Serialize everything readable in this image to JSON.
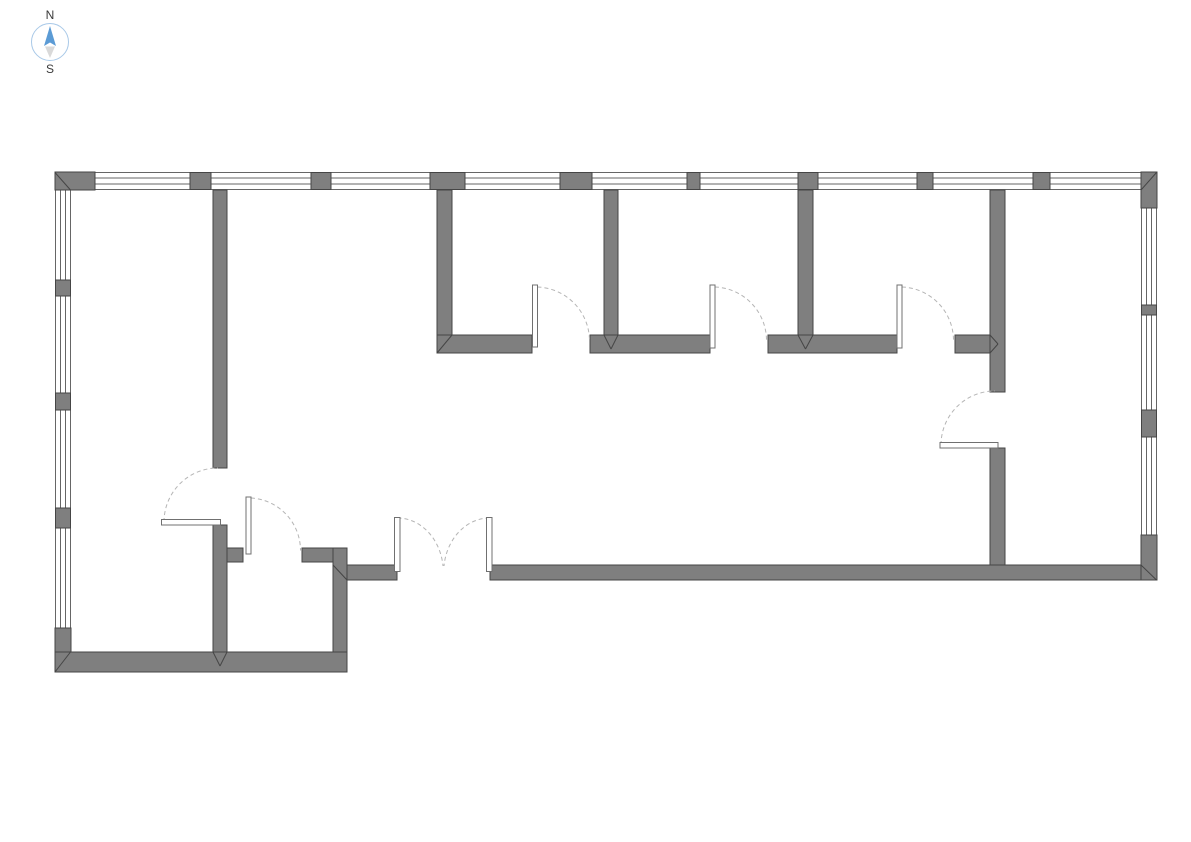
{
  "canvas": {
    "width": 1191,
    "height": 842
  },
  "compass": {
    "north_label": "N",
    "south_label": "S"
  },
  "colors": {
    "background": "#ffffff",
    "wall_fill": "#7f7f7f",
    "wall_stroke": "#454545",
    "window_stroke": "#666666",
    "arc_stroke": "#b5b5b5",
    "leaf_fill": "#ffffff",
    "leaf_stroke": "#707070",
    "compass_circle": "#a9c9e8",
    "compass_north": "#5b9bd5",
    "compass_south": "#d9d9d9",
    "compass_text": "#3a3a3a"
  },
  "plan": {
    "windows": [
      {
        "name": "window-band-north",
        "dir": "h",
        "x": 55.5,
        "y": 172.5,
        "w": 1101,
        "h": 17
      },
      {
        "name": "window-band-west",
        "dir": "v",
        "x": 55.5,
        "y": 188,
        "w": 15,
        "h": 440
      },
      {
        "name": "window-band-east",
        "dir": "v",
        "x": 1141.5,
        "y": 205,
        "w": 15,
        "h": 332
      }
    ],
    "piers": [
      {
        "name": "window-pier-north-1",
        "x": 190,
        "y": 172.5,
        "w": 21,
        "h": 17
      },
      {
        "name": "window-pier-north-2",
        "x": 311,
        "y": 172.5,
        "w": 20,
        "h": 17
      },
      {
        "name": "window-pier-north-3",
        "x": 430,
        "y": 172.5,
        "w": 35,
        "h": 17
      },
      {
        "name": "window-pier-north-4",
        "x": 560,
        "y": 172.5,
        "w": 32,
        "h": 17
      },
      {
        "name": "window-pier-north-5",
        "x": 687,
        "y": 172.5,
        "w": 13,
        "h": 17
      },
      {
        "name": "window-pier-north-6",
        "x": 798,
        "y": 172.5,
        "w": 20,
        "h": 17
      },
      {
        "name": "window-pier-north-7",
        "x": 917,
        "y": 172.5,
        "w": 16,
        "h": 17
      },
      {
        "name": "window-pier-north-8",
        "x": 1033,
        "y": 172.5,
        "w": 17,
        "h": 17
      },
      {
        "name": "window-pier-west-1",
        "x": 55.5,
        "y": 280,
        "w": 15,
        "h": 16
      },
      {
        "name": "window-pier-west-2",
        "x": 55.5,
        "y": 393,
        "w": 15,
        "h": 17
      },
      {
        "name": "window-pier-west-3",
        "x": 55.5,
        "y": 508,
        "w": 15,
        "h": 20
      },
      {
        "name": "window-pier-east-1",
        "x": 1141.5,
        "y": 305,
        "w": 15,
        "h": 10
      },
      {
        "name": "window-pier-east-2",
        "x": 1141.5,
        "y": 410,
        "w": 15,
        "h": 27
      }
    ],
    "corner_blocks": [
      {
        "name": "wall-corner-northwest",
        "x": 55,
        "y": 172,
        "w": 40,
        "h": 18
      },
      {
        "name": "wall-corner-northeast",
        "x": 1141,
        "y": 172,
        "w": 16,
        "h": 36
      },
      {
        "name": "wall-corner-southeast",
        "x": 1141,
        "y": 535,
        "w": 16,
        "h": 45
      },
      {
        "name": "wall-corner-southwest",
        "x": 55,
        "y": 628,
        "w": 16,
        "h": 44
      }
    ],
    "walls": [
      {
        "name": "left-room-partition-upper",
        "x": 213,
        "y": 190,
        "w": 14,
        "h": 278
      },
      {
        "name": "left-room-partition-lower",
        "x": 213,
        "y": 525,
        "w": 14,
        "h": 127
      },
      {
        "name": "room-divider-1",
        "x": 437,
        "y": 190,
        "w": 15,
        "h": 146
      },
      {
        "name": "room-divider-2",
        "x": 604,
        "y": 190,
        "w": 14,
        "h": 146
      },
      {
        "name": "room-divider-3",
        "x": 798,
        "y": 190,
        "w": 15,
        "h": 146
      },
      {
        "name": "right-partition-upper",
        "x": 990,
        "y": 190,
        "w": 15,
        "h": 202
      },
      {
        "name": "right-partition-lower",
        "x": 990,
        "y": 448,
        "w": 15,
        "h": 118
      },
      {
        "name": "rooms-front-wall-a",
        "x": 437,
        "y": 335,
        "w": 95,
        "h": 18
      },
      {
        "name": "rooms-front-wall-b",
        "x": 590,
        "y": 335,
        "w": 120,
        "h": 18
      },
      {
        "name": "rooms-front-wall-c",
        "x": 768,
        "y": 335,
        "w": 129,
        "h": 18
      },
      {
        "name": "rooms-front-wall-d",
        "x": 955,
        "y": 335,
        "w": 35,
        "h": 18
      },
      {
        "name": "closet-top-wall-a",
        "x": 227,
        "y": 548,
        "w": 16,
        "h": 14
      },
      {
        "name": "closet-top-wall-b",
        "x": 302,
        "y": 548,
        "w": 31,
        "h": 14
      },
      {
        "name": "closet-right-wall",
        "x": 333,
        "y": 548,
        "w": 14,
        "h": 105
      },
      {
        "name": "bottom-wall-left",
        "x": 55,
        "y": 652,
        "w": 292,
        "h": 20
      },
      {
        "name": "bottom-wall-mid",
        "x": 347,
        "y": 565,
        "w": 50,
        "h": 15
      },
      {
        "name": "bottom-wall-right",
        "x": 490,
        "y": 565,
        "w": 651,
        "h": 15
      }
    ],
    "miters": [
      {
        "x1": 55,
        "y1": 172.5,
        "x2": 70.5,
        "y2": 190
      },
      {
        "x1": 1156.5,
        "y1": 172.5,
        "x2": 1141,
        "y2": 190
      },
      {
        "x1": 1141,
        "y1": 565,
        "x2": 1156.5,
        "y2": 580
      },
      {
        "x1": 70.5,
        "y1": 652,
        "x2": 55,
        "y2": 672
      },
      {
        "x1": 437,
        "y1": 353,
        "x2": 452,
        "y2": 335
      },
      {
        "x1": 604,
        "y1": 335,
        "x2": 611,
        "y2": 349
      },
      {
        "x1": 618,
        "y1": 335,
        "x2": 611,
        "y2": 349
      },
      {
        "x1": 798,
        "y1": 335,
        "x2": 805.5,
        "y2": 349
      },
      {
        "x1": 813,
        "y1": 335,
        "x2": 805.5,
        "y2": 349
      },
      {
        "x1": 990,
        "y1": 335,
        "x2": 998,
        "y2": 344
      },
      {
        "x1": 990,
        "y1": 353,
        "x2": 998,
        "y2": 344
      },
      {
        "x1": 213,
        "y1": 652,
        "x2": 220,
        "y2": 666
      },
      {
        "x1": 227,
        "y1": 652,
        "x2": 220,
        "y2": 666
      },
      {
        "x1": 333,
        "y1": 565,
        "x2": 347,
        "y2": 580
      }
    ],
    "doors": [
      {
        "name": "room1-door",
        "leaf": {
          "x": 532.5,
          "y": 285,
          "w": 5,
          "h": 62
        },
        "arc": "M537.5 287 A54 54 0 0 1 589.5 341"
      },
      {
        "name": "room2-door",
        "leaf": {
          "x": 710,
          "y": 285,
          "w": 5,
          "h": 63
        },
        "arc": "M715 287 A53.5 53.5 0 0 1 766.5 340.5"
      },
      {
        "name": "room3-door",
        "leaf": {
          "x": 897,
          "y": 285,
          "w": 5,
          "h": 63
        },
        "arc": "M902 287 A53.5 53.5 0 0 1 953.5 340.5"
      },
      {
        "name": "hall-east-door",
        "leaf": {
          "x": 940,
          "y": 442.5,
          "w": 58,
          "h": 5.5
        },
        "arc": "M941 445 A54 54 0 0 1 995 391"
      },
      {
        "name": "left-room-door",
        "leaf": {
          "x": 161.5,
          "y": 519.5,
          "w": 59,
          "h": 5.5
        },
        "arc": "M164 522 A54 54 0 0 1 218 468"
      },
      {
        "name": "closet-door",
        "leaf": {
          "x": 246,
          "y": 497,
          "w": 5,
          "h": 57
        },
        "arc": "M251 498 A52.5 52.5 0 0 1 300.5 550.5"
      },
      {
        "name": "entrance-double-door-left",
        "leaf": {
          "x": 394.5,
          "y": 517.5,
          "w": 5.5,
          "h": 54
        },
        "arc": "M397.5 518 A46 54 0 0 1 443 566"
      },
      {
        "name": "entrance-double-door-right",
        "leaf": {
          "x": 486.5,
          "y": 517.5,
          "w": 5.5,
          "h": 54
        },
        "arc": "M489.5 518 A46 54 0 0 0 444 566"
      }
    ]
  }
}
